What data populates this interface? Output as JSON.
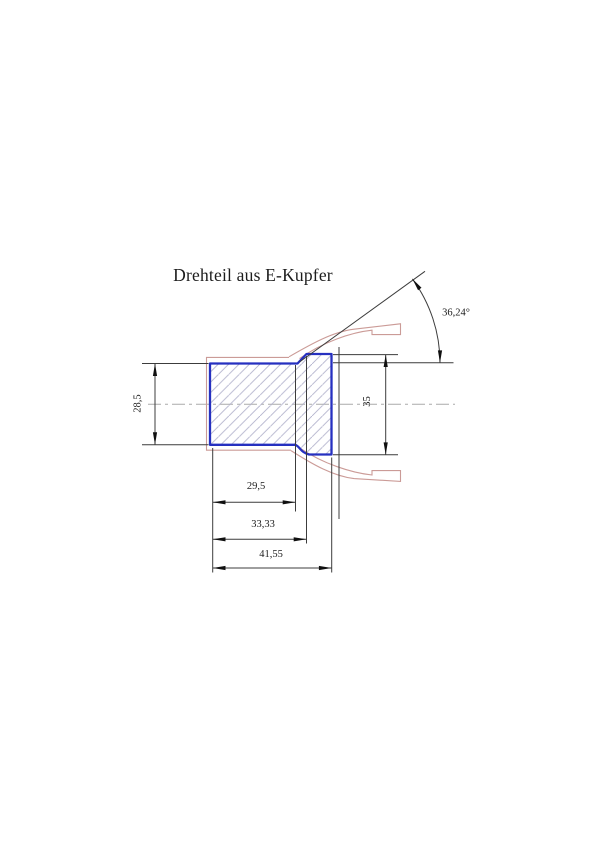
{
  "drawing": {
    "title": "Drehteil aus E-Kupfer",
    "dimensions": {
      "small_diameter": "28,5",
      "large_diameter": "35",
      "length_small_section": "29,5",
      "length_to_full_diameter": "33,33",
      "total_length": "41,55",
      "flare_angle": "36,24°"
    },
    "colors": {
      "part_outline": "#2630c0",
      "hatch": "#b2b2cc",
      "raw_contour": "#cb9b97",
      "dimension_lines": "#3c3c3c",
      "arrow_fill": "#101010",
      "centerline": "#aaaaaa",
      "text": "#1c1c1c",
      "background": "#ffffff"
    }
  }
}
